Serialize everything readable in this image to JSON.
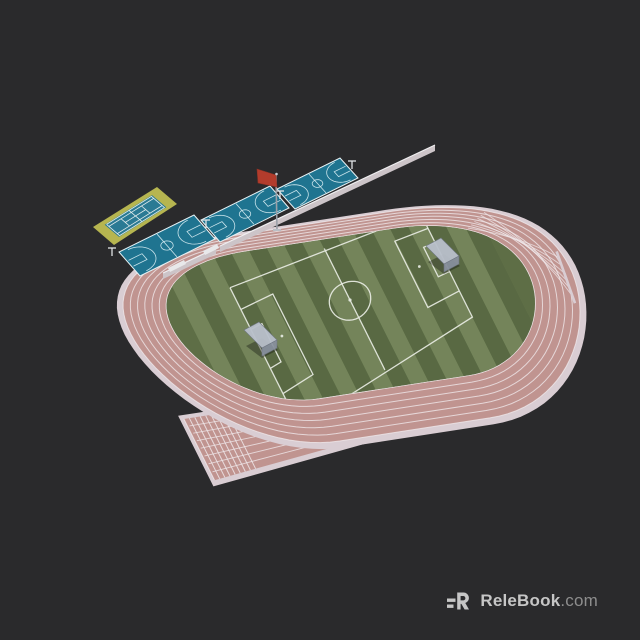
{
  "watermark": {
    "brand": "ReleBook",
    "suffix": ".com",
    "logo_icon": "relebook-logo"
  },
  "scene": {
    "type": "3d-model-render",
    "subject": "athletics-stadium-with-soccer-field",
    "lane_count": 6,
    "basketball_court_count": 3,
    "tennis_court_count": 1,
    "goal_count": 2,
    "flag_color_name": "red"
  },
  "colors": {
    "background": "#2a2a2c",
    "track_border": "#d9cdd3",
    "track_pink": "#c09490",
    "lane_line": "#efe7ea",
    "grass_base": "#5e6e46",
    "stripe_light": "#74845a",
    "stripe_dark": "#596943",
    "field_line": "#e8ece3",
    "court_blue": "#1f7490",
    "court_line": "#d2e9ef",
    "tennis_pad": "#b6b550",
    "tennis_blue": "#2a7a94",
    "wall_gray": "#ccc4c8",
    "wall_top": "#efeef0",
    "goal_light": "#b9c0cb",
    "goal_dark": "#8a92a0",
    "goal_edge": "#6f7683",
    "flag_red": "#b23c2c",
    "pole_gray": "#9aa0a8",
    "hoop_white": "#dfe3e6",
    "watermark_brand": "#c6c6c6",
    "watermark_suffix": "#8d8d8d",
    "shadow": "rgba(0,0,0,0.32)"
  }
}
